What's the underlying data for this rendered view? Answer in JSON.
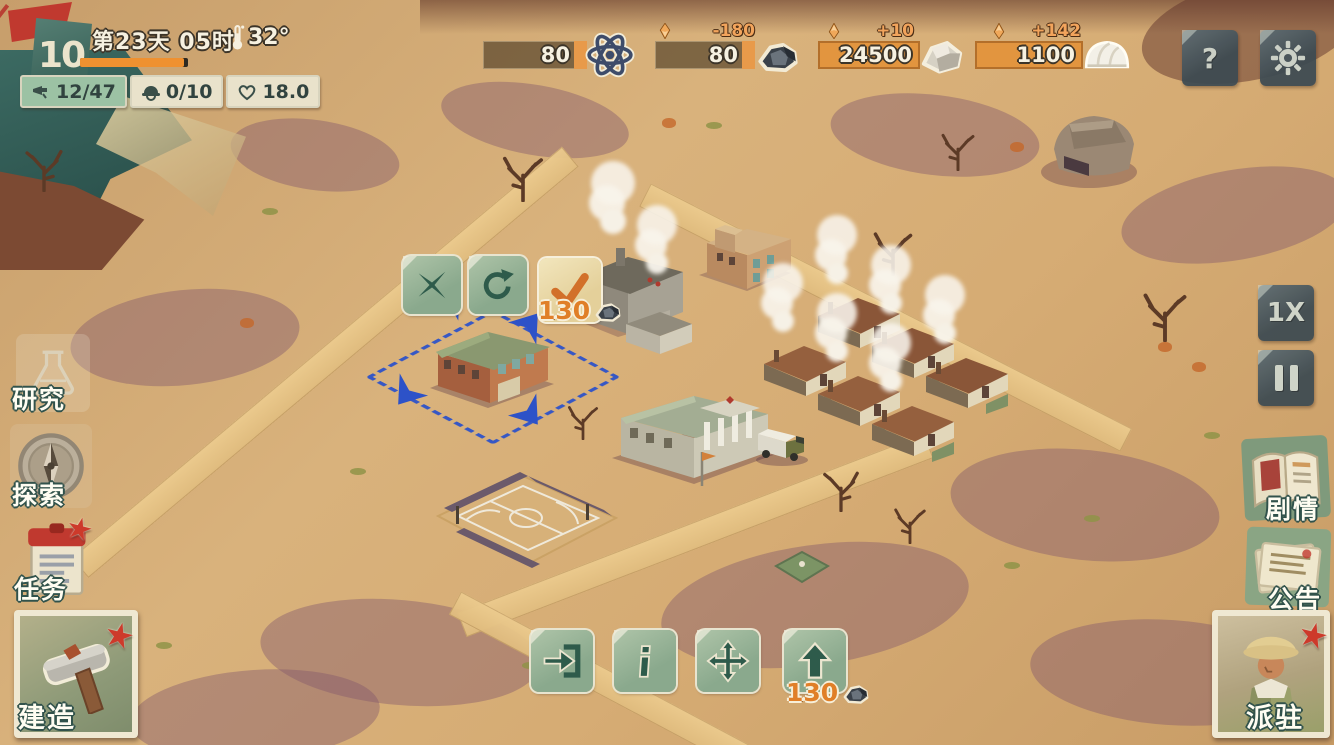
{
  "top_left": {
    "level": "10",
    "day": "第23天",
    "hour": "05时",
    "temperature": "32°",
    "stats": [
      {
        "name": "citizens",
        "icon": "whistle-icon",
        "value": "12/47"
      },
      {
        "name": "workers",
        "icon": "helmet-icon",
        "value": "0/10"
      },
      {
        "name": "morale",
        "icon": "heart-icon",
        "value": "18.0"
      }
    ]
  },
  "resources": [
    {
      "name": "science",
      "icon": "atom-icon",
      "value": "80",
      "delta": ""
    },
    {
      "name": "coal",
      "icon": "coal-icon",
      "value": "80",
      "delta": "-180",
      "trend": "down"
    },
    {
      "name": "stone",
      "icon": "stone-icon",
      "value": "24500",
      "delta": "+10",
      "trend": "up"
    },
    {
      "name": "salt",
      "icon": "salt-icon",
      "value": "1100",
      "delta": "+142",
      "trend": "up"
    }
  ],
  "top_right": {
    "help": "?"
  },
  "left_menu": {
    "research": "研究",
    "explore": "探索",
    "tasks": "任务",
    "build": "建造"
  },
  "right_menu": {
    "speed": "1X",
    "story": "剧情",
    "notice": "公告",
    "dispatch": "派驻"
  },
  "placement": {
    "cost": "130"
  },
  "building_actions": {
    "upgrade_cost": "130"
  },
  "colors": {
    "accent_orange": "#e8923c",
    "selection_blue": "#2d52c8",
    "hud_green": "#9cc2a4",
    "panel_dark": "#44525a",
    "button_green": "#9db79a",
    "flag_red": "#c0392f"
  }
}
